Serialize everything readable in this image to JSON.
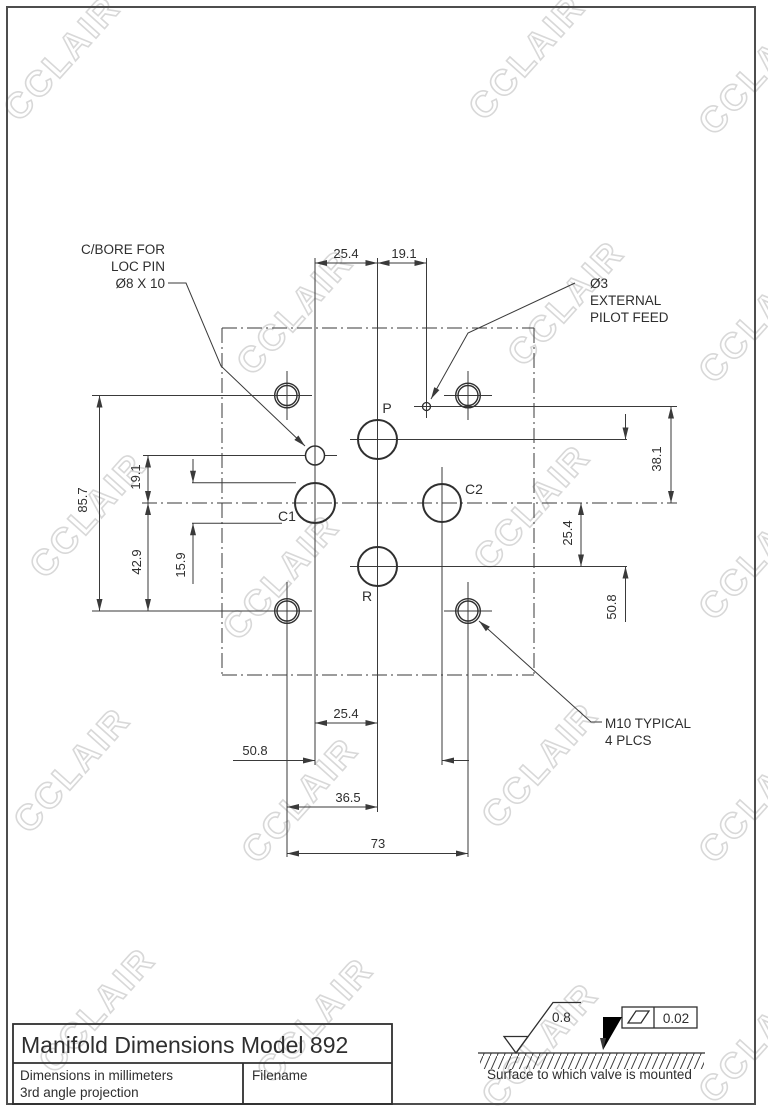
{
  "watermark": {
    "text": "CCLAIR",
    "positions": [
      [
        62,
        58
      ],
      [
        527,
        57
      ],
      [
        757,
        72
      ],
      [
        295,
        312
      ],
      [
        566,
        303
      ],
      [
        757,
        320
      ],
      [
        88,
        515
      ],
      [
        281,
        577
      ],
      [
        532,
        507
      ],
      [
        757,
        557
      ],
      [
        72,
        770
      ],
      [
        300,
        800
      ],
      [
        540,
        765
      ],
      [
        757,
        800
      ],
      [
        97,
        1010
      ],
      [
        315,
        1020
      ],
      [
        540,
        1045
      ],
      [
        757,
        1040
      ]
    ]
  },
  "callouts": {
    "cbore": {
      "line1": "C/BORE FOR",
      "line2": "LOC PIN",
      "line3": "Ø8 X 10"
    },
    "pilot": {
      "line1": "Ø3",
      "line2": "EXTERNAL",
      "line3": "PILOT FEED"
    },
    "m10": {
      "line1": "M10 TYPICAL",
      "line2": "4 PLCS"
    }
  },
  "ports": {
    "p": "P",
    "c1": "C1",
    "c2": "C2",
    "r": "R"
  },
  "dimensions": {
    "top_left_spacing": "25.4",
    "top_right_spacing": "19.1",
    "left_overall": "85.7",
    "left_locpin_to_center": "19.1",
    "left_center_to_bottom": "42.9",
    "port_diameter": "15.9",
    "right_pilot_to_center": "38.1",
    "right_center_to_r": "25.4",
    "right_p_to_r": "50.8",
    "bottom_c1_to_pr": "25.4",
    "bottom_c1_to_c2": "50.8",
    "bottom_bolt_to_pr": "36.5",
    "bottom_bolt_spacing": "73"
  },
  "title_block": {
    "title": "Manifold Dimensions Model 892",
    "note1": "Dimensions in millimeters",
    "note2": "3rd angle projection",
    "filename_label": "Filename"
  },
  "surface_note": {
    "roughness": "0.8",
    "flatness": "0.02",
    "caption": "Surface to which valve is mounted"
  }
}
